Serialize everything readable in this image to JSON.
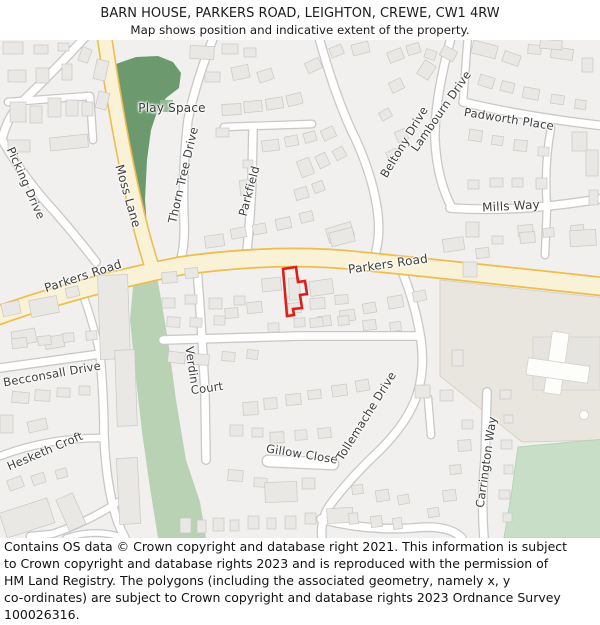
{
  "header": {
    "title": "BARN HOUSE, PARKERS ROAD, LEIGHTON, CREWE, CW1 4RW",
    "subtitle": "Map shows position and indicative extent of the property."
  },
  "map": {
    "road_labels": [
      {
        "text": "Picking Drive",
        "x": 26,
        "y": 143,
        "rot": 66,
        "size": 11.5
      },
      {
        "text": "Moss Lane",
        "x": 128,
        "y": 156,
        "rot": 74,
        "size": 12
      },
      {
        "text": "Play Space",
        "x": 172,
        "y": 68,
        "rot": 0,
        "size": 12
      },
      {
        "text": "Thorn Tree Drive",
        "x": 183,
        "y": 135,
        "rot": -77,
        "size": 11.5
      },
      {
        "text": "Parkfield",
        "x": 249,
        "y": 151,
        "rot": -75,
        "size": 11.5
      },
      {
        "text": "Beltony Drive",
        "x": 404,
        "y": 102,
        "rot": -59,
        "size": 11.5
      },
      {
        "text": "Lambourn Drive",
        "x": 441,
        "y": 71,
        "rot": -55,
        "size": 11.5
      },
      {
        "text": "Padworth Place",
        "x": 509,
        "y": 79,
        "rot": 9,
        "size": 11.5
      },
      {
        "text": "Mills Way",
        "x": 511,
        "y": 166,
        "rot": -3,
        "size": 12
      },
      {
        "text": "Parkers Road",
        "x": 83,
        "y": 236,
        "rot": -18,
        "size": 12
      },
      {
        "text": "Parkers Road",
        "x": 388,
        "y": 224,
        "rot": -8,
        "size": 12
      },
      {
        "text": "Becconsall Drive",
        "x": 52,
        "y": 334,
        "rot": -10,
        "size": 11.5
      },
      {
        "text": "Hesketh Croft",
        "x": 45,
        "y": 411,
        "rot": -23,
        "size": 11.5
      },
      {
        "text": "Verdin",
        "x": 192,
        "y": 325,
        "rot": 82,
        "size": 11.5
      },
      {
        "text": "Court",
        "x": 207,
        "y": 348,
        "rot": -8,
        "size": 11.5
      },
      {
        "text": "Gillow Close",
        "x": 302,
        "y": 414,
        "rot": 9,
        "size": 11.5
      },
      {
        "text": "Tollemache Drive",
        "x": 366,
        "y": 376,
        "rot": -58,
        "size": 11.5
      },
      {
        "text": "Carrington Way",
        "x": 486,
        "y": 422,
        "rot": -82,
        "size": 11.5
      }
    ],
    "colors": {
      "map_bg": "#f1f0ee",
      "road_fill": "#ffffff",
      "road_casing": "#c9c8c6",
      "main_road_fill": "#faf2d7",
      "main_road_casing": "#eebd4f",
      "building_fill": "#e9e8e5",
      "building_stroke": "#c9c8c5",
      "play_space_green": "#6c9a6e",
      "play_space_inner": "#93b893",
      "verge_green": "#b8d2b3",
      "field_green": "#c8dec6",
      "tan_area": "#e9e5df",
      "tan_stroke": "#d6d2cb",
      "gray_block": "#e6e4e0",
      "label_color": "#3e3e3e",
      "property_outline": "#e11d17"
    }
  },
  "footer": {
    "text": "Contains OS data © Crown copyright and database right 2021. This information is subject\nto Crown copyright and database rights 2023 and is reproduced with the permission of\nHM Land Registry. The polygons (including the associated geometry, namely x, y\nco-ordinates) are subject to Crown copyright and database rights 2023 Ordnance Survey\n100026316."
  }
}
